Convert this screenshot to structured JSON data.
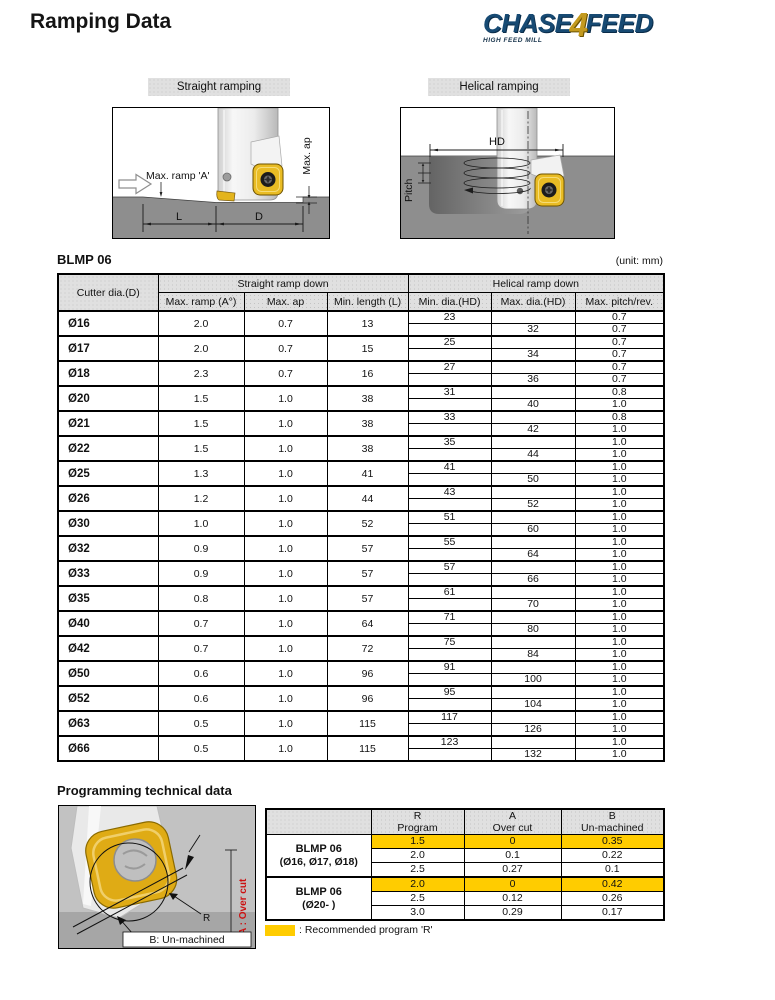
{
  "page": {
    "title": "Ramping Data",
    "unit_note": "(unit: mm)"
  },
  "logo": {
    "chase": "CHASE",
    "four": "4",
    "feed": "FEED",
    "tagline": "HIGH FEED MILL"
  },
  "colors": {
    "highlight_yellow": "#ffcc00",
    "insert_yellow": "#e9bc24",
    "workpiece_gray": "#8e8e8e",
    "logo_blue": "#174a73",
    "logo_gold": "#c39a1f",
    "overcut_red": "#cc1111"
  },
  "diagrams": {
    "straight": {
      "label": "Straight ramping",
      "max_ramp_label": "Max. ramp 'A'",
      "max_ap_label": "Max. ap",
      "l_label": "L",
      "d_label": "D"
    },
    "helical": {
      "label": "Helical ramping",
      "hd_label": "HD",
      "pitch_label": "Pitch"
    }
  },
  "main_table": {
    "title": "BLMP 06",
    "col_dia": "Cutter dia.(D)",
    "group_straight": "Straight ramp down",
    "group_helical": "Helical ramp down",
    "sub_headers": [
      "Max. ramp (A°)",
      "Max. ap",
      "Min. length (L)",
      "Min. dia.(HD)",
      "Max. dia.(HD)",
      "Max. pitch/rev."
    ],
    "rows": [
      {
        "dia": "Ø16",
        "max_ramp": "2.0",
        "max_ap": "0.7",
        "min_length": "13",
        "min_dia": "23",
        "max_dia": "32",
        "pitch_top": "0.7",
        "pitch_bottom": "0.7"
      },
      {
        "dia": "Ø17",
        "max_ramp": "2.0",
        "max_ap": "0.7",
        "min_length": "15",
        "min_dia": "25",
        "max_dia": "34",
        "pitch_top": "0.7",
        "pitch_bottom": "0.7"
      },
      {
        "dia": "Ø18",
        "max_ramp": "2.3",
        "max_ap": "0.7",
        "min_length": "16",
        "min_dia": "27",
        "max_dia": "36",
        "pitch_top": "0.7",
        "pitch_bottom": "0.7"
      },
      {
        "dia": "Ø20",
        "max_ramp": "1.5",
        "max_ap": "1.0",
        "min_length": "38",
        "min_dia": "31",
        "max_dia": "40",
        "pitch_top": "0.8",
        "pitch_bottom": "1.0"
      },
      {
        "dia": "Ø21",
        "max_ramp": "1.5",
        "max_ap": "1.0",
        "min_length": "38",
        "min_dia": "33",
        "max_dia": "42",
        "pitch_top": "0.8",
        "pitch_bottom": "1.0"
      },
      {
        "dia": "Ø22",
        "max_ramp": "1.5",
        "max_ap": "1.0",
        "min_length": "38",
        "min_dia": "35",
        "max_dia": "44",
        "pitch_top": "1.0",
        "pitch_bottom": "1.0"
      },
      {
        "dia": "Ø25",
        "max_ramp": "1.3",
        "max_ap": "1.0",
        "min_length": "41",
        "min_dia": "41",
        "max_dia": "50",
        "pitch_top": "1.0",
        "pitch_bottom": "1.0"
      },
      {
        "dia": "Ø26",
        "max_ramp": "1.2",
        "max_ap": "1.0",
        "min_length": "44",
        "min_dia": "43",
        "max_dia": "52",
        "pitch_top": "1.0",
        "pitch_bottom": "1.0"
      },
      {
        "dia": "Ø30",
        "max_ramp": "1.0",
        "max_ap": "1.0",
        "min_length": "52",
        "min_dia": "51",
        "max_dia": "60",
        "pitch_top": "1.0",
        "pitch_bottom": "1.0"
      },
      {
        "dia": "Ø32",
        "max_ramp": "0.9",
        "max_ap": "1.0",
        "min_length": "57",
        "min_dia": "55",
        "max_dia": "64",
        "pitch_top": "1.0",
        "pitch_bottom": "1.0"
      },
      {
        "dia": "Ø33",
        "max_ramp": "0.9",
        "max_ap": "1.0",
        "min_length": "57",
        "min_dia": "57",
        "max_dia": "66",
        "pitch_top": "1.0",
        "pitch_bottom": "1.0"
      },
      {
        "dia": "Ø35",
        "max_ramp": "0.8",
        "max_ap": "1.0",
        "min_length": "57",
        "min_dia": "61",
        "max_dia": "70",
        "pitch_top": "1.0",
        "pitch_bottom": "1.0"
      },
      {
        "dia": "Ø40",
        "max_ramp": "0.7",
        "max_ap": "1.0",
        "min_length": "64",
        "min_dia": "71",
        "max_dia": "80",
        "pitch_top": "1.0",
        "pitch_bottom": "1.0"
      },
      {
        "dia": "Ø42",
        "max_ramp": "0.7",
        "max_ap": "1.0",
        "min_length": "72",
        "min_dia": "75",
        "max_dia": "84",
        "pitch_top": "1.0",
        "pitch_bottom": "1.0"
      },
      {
        "dia": "Ø50",
        "max_ramp": "0.6",
        "max_ap": "1.0",
        "min_length": "96",
        "min_dia": "91",
        "max_dia": "100",
        "pitch_top": "1.0",
        "pitch_bottom": "1.0"
      },
      {
        "dia": "Ø52",
        "max_ramp": "0.6",
        "max_ap": "1.0",
        "min_length": "96",
        "min_dia": "95",
        "max_dia": "104",
        "pitch_top": "1.0",
        "pitch_bottom": "1.0"
      },
      {
        "dia": "Ø63",
        "max_ramp": "0.5",
        "max_ap": "1.0",
        "min_length": "115",
        "min_dia": "117",
        "max_dia": "126",
        "pitch_top": "1.0",
        "pitch_bottom": "1.0"
      },
      {
        "dia": "Ø66",
        "max_ramp": "0.5",
        "max_ap": "1.0",
        "min_length": "115",
        "min_dia": "123",
        "max_dia": "132",
        "pitch_top": "1.0",
        "pitch_bottom": "1.0"
      }
    ]
  },
  "programming": {
    "title": "Programming technical data",
    "col_headers": [
      {
        "line1": "R",
        "line2": "Program"
      },
      {
        "line1": "A",
        "line2": "Over cut"
      },
      {
        "line1": "B",
        "line2": "Un-machined"
      }
    ],
    "groups": [
      {
        "label_line1": "BLMP 06",
        "label_line2": "(Ø16, Ø17, Ø18)",
        "rows": [
          {
            "r": "1.5",
            "a": "0",
            "b": "0.35",
            "highlight": true
          },
          {
            "r": "2.0",
            "a": "0.1",
            "b": "0.22",
            "highlight": false
          },
          {
            "r": "2.5",
            "a": "0.27",
            "b": "0.1",
            "highlight": false
          }
        ]
      },
      {
        "label_line1": "BLMP 06",
        "label_line2": "(Ø20- )",
        "rows": [
          {
            "r": "2.0",
            "a": "0",
            "b": "0.42",
            "highlight": true
          },
          {
            "r": "2.5",
            "a": "0.12",
            "b": "0.26",
            "highlight": false
          },
          {
            "r": "3.0",
            "a": "0.29",
            "b": "0.17",
            "highlight": false
          }
        ]
      }
    ],
    "legend": ": Recommended program 'R'",
    "image_labels": {
      "r": "R",
      "a": "A : Over cut",
      "b": "B: Un-machined"
    }
  }
}
